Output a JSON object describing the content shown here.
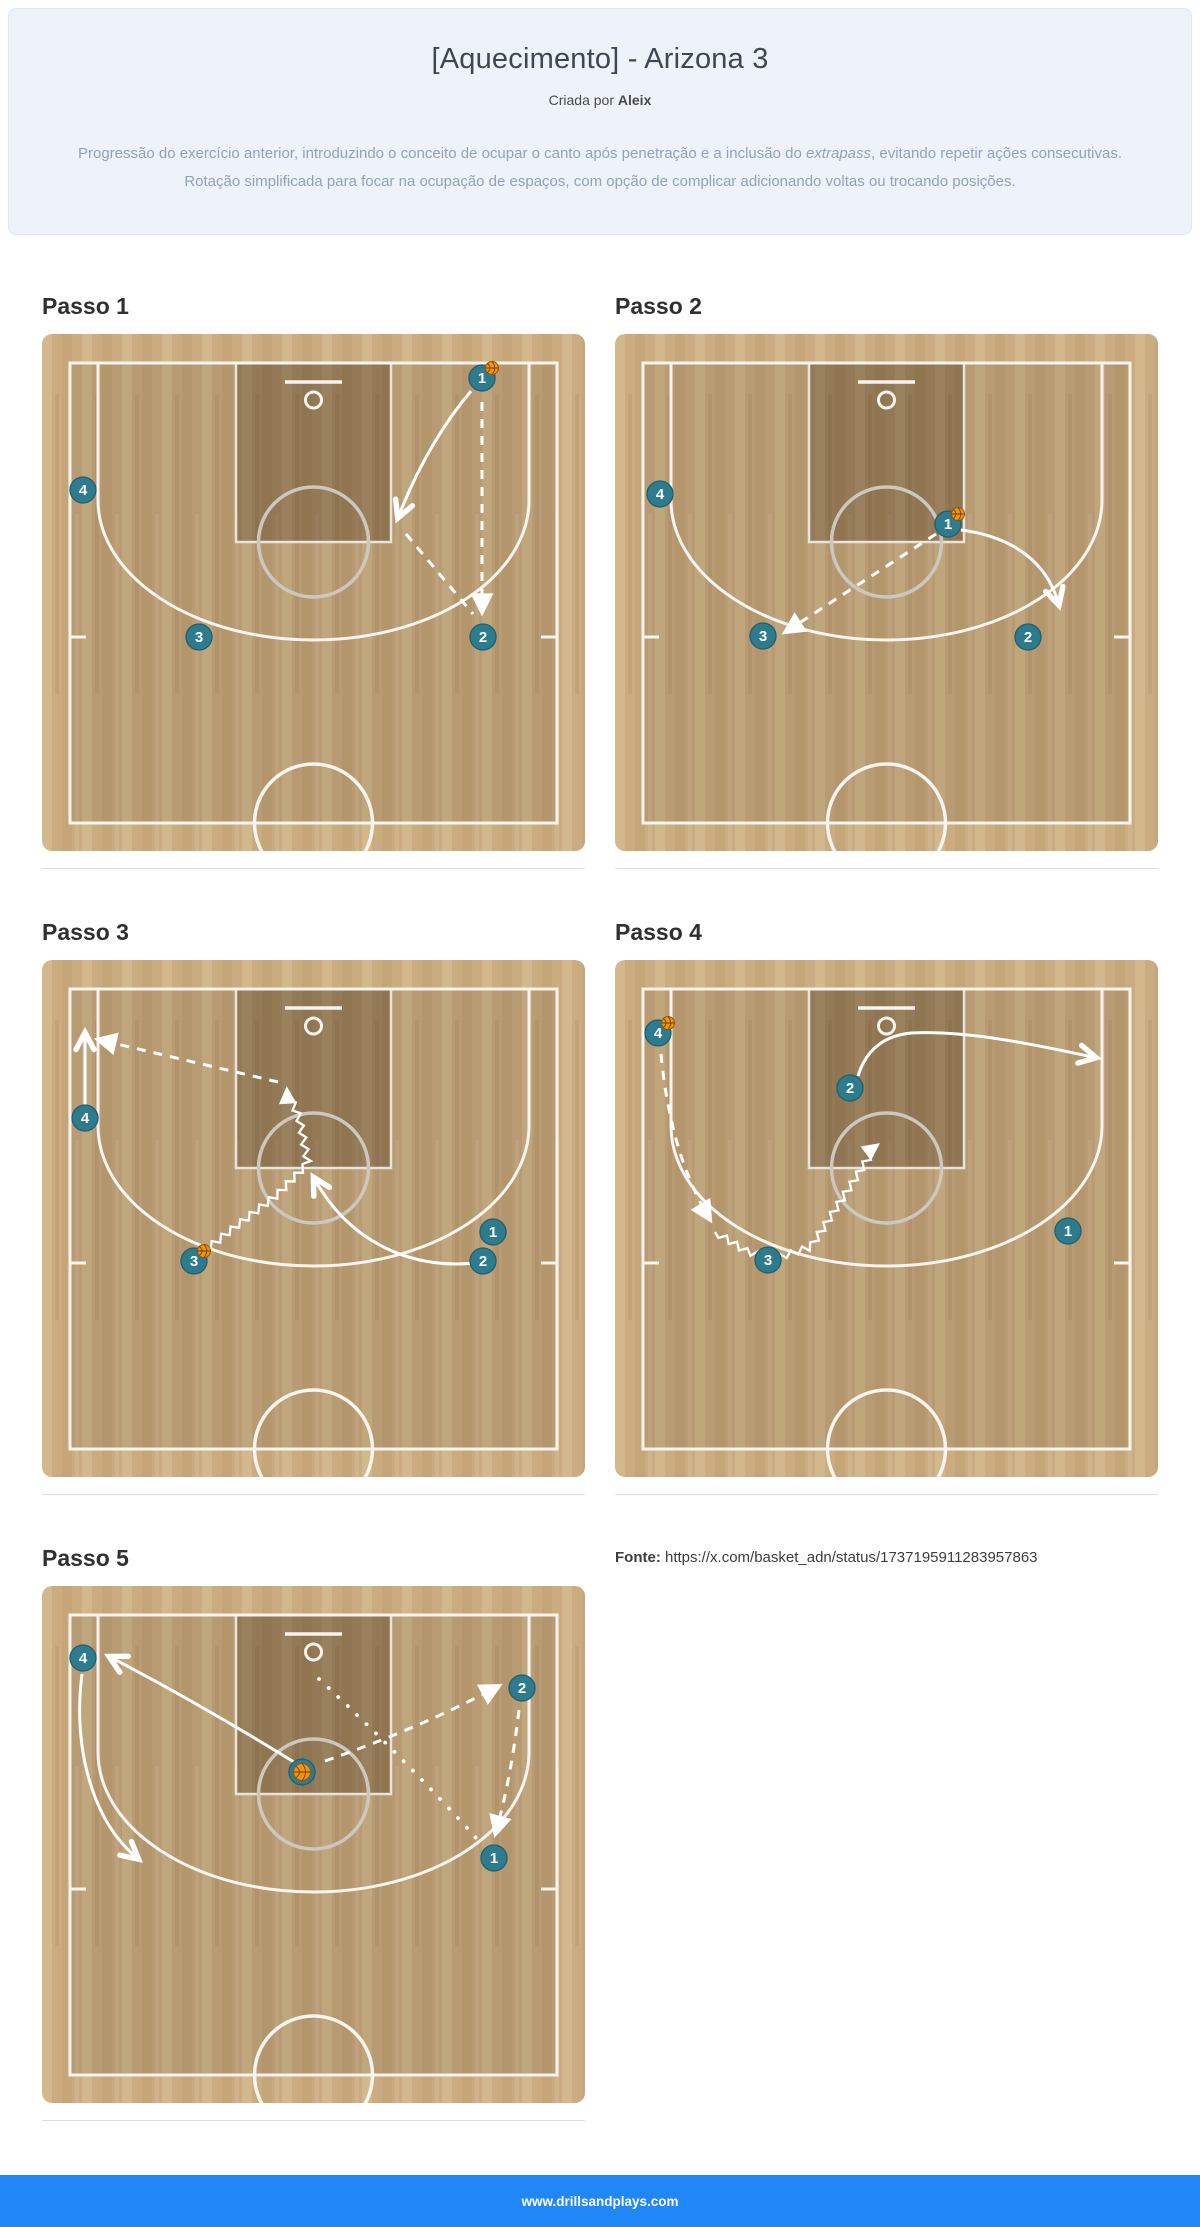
{
  "header": {
    "title": "[Aquecimento] - Arizona 3",
    "byline_prefix": "Criada por",
    "author": "Aleix",
    "description_part1": "Progressão do exercício anterior, introduzindo o conceito de ocupar o canto após penetração e a inclusão do ",
    "description_italic": "extrapass",
    "description_part2": ", evitando repetir ações consecutivas. Rotação simplificada para focar na ocupação de espaços, com opção de complicar adicionando voltas ou trocando posições."
  },
  "source": {
    "label": "Fonte:",
    "url": "https://x.com/basket_adn/status/1737195911283957863"
  },
  "footer": {
    "text": "www.drillsandplays.com",
    "bg": "#2187f6"
  },
  "colors": {
    "player_fill": "#2e7b8e",
    "player_border": "#1f5f6e",
    "ball": "#f2920f",
    "ball_border": "#96570a",
    "court_base": "#cbac81",
    "plank_light": "#d3b88d",
    "plank_dark": "#c5a679",
    "inner_overlay": "rgba(70,50,25,0.13)",
    "key_overlay": "rgba(60,42,18,0.30)",
    "line_white": "#f6f4ef",
    "line_gray": "#ccc7bf",
    "header_bg": "#edf3f9",
    "footer_bg": "#2187f6"
  },
  "steps": [
    {
      "label": "Passo 1",
      "players": [
        {
          "n": "4",
          "x": 41,
          "y": 156
        },
        {
          "n": "3",
          "x": 157,
          "y": 303
        },
        {
          "n": "2",
          "x": 441,
          "y": 303
        },
        {
          "n": "1",
          "x": 440,
          "y": 44,
          "ball": "tr"
        }
      ],
      "arrows": [
        {
          "type": "cut",
          "d": "M 429 57 Q 386 108 357 181"
        },
        {
          "type": "pass",
          "d": "M 440 68 L 440 276"
        },
        {
          "type": "pass",
          "d": "M 364 200 L 431 280",
          "head": false
        }
      ]
    },
    {
      "label": "Passo 2",
      "players": [
        {
          "n": "4",
          "x": 45,
          "y": 160
        },
        {
          "n": "1",
          "x": 333,
          "y": 190,
          "ball": "tr"
        },
        {
          "n": "3",
          "x": 148,
          "y": 302
        },
        {
          "n": "2",
          "x": 413,
          "y": 303
        }
      ],
      "arrows": [
        {
          "type": "pass",
          "d": "M 321 200 L 172 297"
        },
        {
          "type": "cut",
          "d": "M 346 196 C 400 203 432 230 443 268"
        }
      ]
    },
    {
      "label": "Passo 3",
      "players": [
        {
          "n": "4",
          "x": 43,
          "y": 158
        },
        {
          "n": "3",
          "x": 152,
          "y": 301,
          "ball": "tr"
        },
        {
          "n": "2",
          "x": 441,
          "y": 301
        },
        {
          "n": "1",
          "x": 451,
          "y": 272
        }
      ],
      "arrows": [
        {
          "type": "cut",
          "d": "M 43 148 L 43 76"
        },
        {
          "type": "pass",
          "d": "M 236 122 L 58 80"
        },
        {
          "type": "dribble",
          "points": [
            [
              162,
              291
            ],
            [
              236,
              234
            ],
            [
              266,
              203
            ],
            [
              257,
              157
            ],
            [
              245,
              131
            ]
          ]
        },
        {
          "type": "cut",
          "d": "M 441 302 C 370 312 308 282 273 220"
        }
      ]
    },
    {
      "label": "Passo 4",
      "players": [
        {
          "n": "4",
          "x": 43,
          "y": 73,
          "ball": "tr"
        },
        {
          "n": "2",
          "x": 235,
          "y": 128
        },
        {
          "n": "3",
          "x": 153,
          "y": 300
        },
        {
          "n": "1",
          "x": 453,
          "y": 271
        }
      ],
      "arrows": [
        {
          "type": "cut",
          "d": "M 243 116 C 250 93 266 76 296 73 C 355 70 425 86 478 97"
        },
        {
          "type": "pass",
          "d": "M 46 94 C 51 148 64 208 94 258"
        },
        {
          "type": "dribble",
          "points": [
            [
              100,
              272
            ],
            [
              131,
              291
            ],
            [
              158,
              299
            ],
            [
              196,
              287
            ],
            [
              238,
              222
            ],
            [
              261,
              186
            ]
          ]
        }
      ]
    },
    {
      "label": "Passo 5",
      "players": [
        {
          "n": "4",
          "x": 41,
          "y": 72
        },
        {
          "n": "3",
          "x": 260,
          "y": 186,
          "ball": "c"
        },
        {
          "n": "2",
          "x": 480,
          "y": 102
        },
        {
          "n": "1",
          "x": 452,
          "y": 272
        }
      ],
      "arrows": [
        {
          "type": "cut",
          "d": "M 252 176 Q 158 118 70 72"
        },
        {
          "type": "cut",
          "d": "M 40 88 C 31 160 49 233 94 271"
        },
        {
          "type": "pass",
          "d": "M 283 175 Q 378 142 455 101"
        },
        {
          "type": "pass",
          "d": "M 477 124 Q 469 192 454 246"
        },
        {
          "type": "shot",
          "d": "M 277 93 Q 362 172 434 252"
        }
      ]
    }
  ]
}
